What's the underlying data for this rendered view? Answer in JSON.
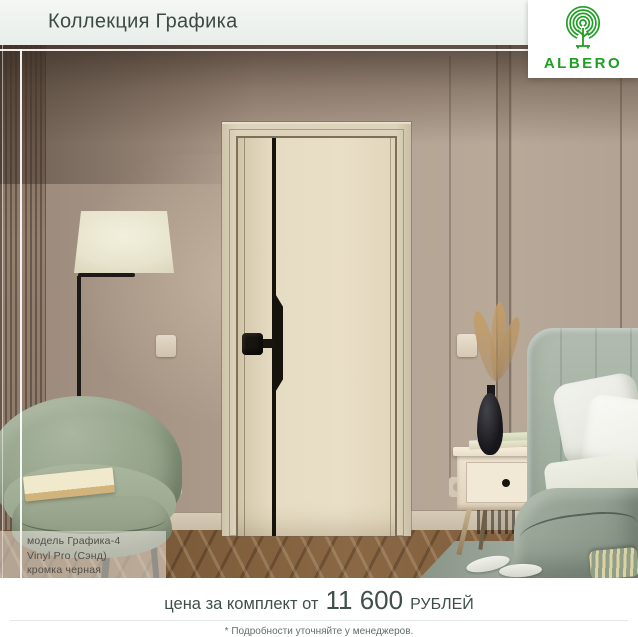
{
  "header": {
    "title": "Коллекция Графика"
  },
  "logo": {
    "brand": "ALBERO",
    "icon": "fingerprint-tree-icon",
    "color": "#1f9e23"
  },
  "scene": {
    "label": {
      "line1": "модель Графика-4",
      "line2": "Vinyl Pro (Сэнд)",
      "line3": "кромка черная"
    }
  },
  "footer": {
    "price_prefix": "цена за комплект от",
    "price_value": "11 600",
    "price_suffix": "РУБЛЕЙ",
    "note": "* Подробности уточняйте у менеджеров."
  },
  "colors": {
    "brand_green": "#1f9e23",
    "header_bg": "#eef2ef",
    "title_text": "#3d4a46",
    "price_text": "#404f49",
    "wall": "#ab9889",
    "door": "#e6dcc3",
    "accent_black": "#16120c"
  }
}
